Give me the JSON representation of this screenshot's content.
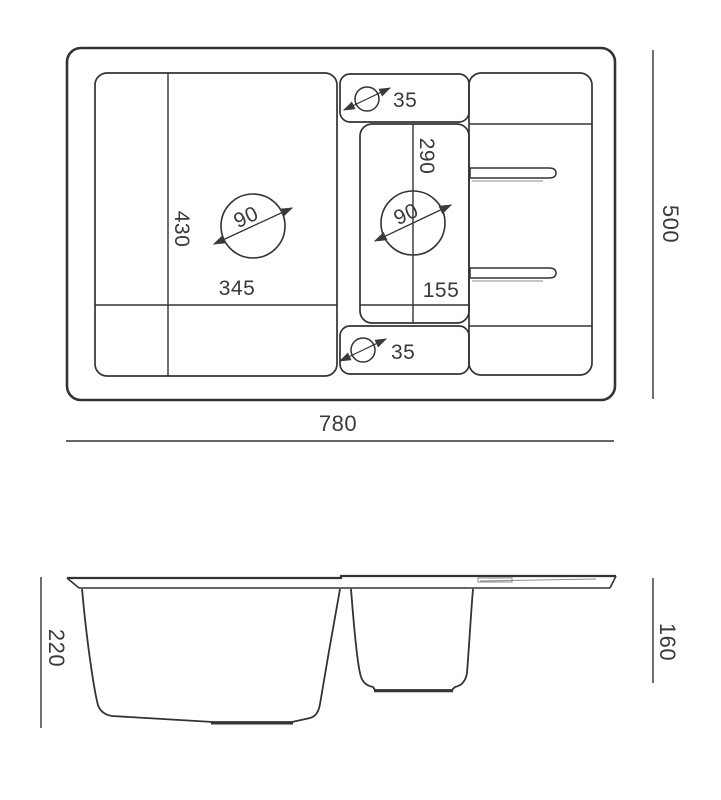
{
  "colors": {
    "line": "#333333",
    "line_soft": "#8a8a8a",
    "text": "#3a3a3a",
    "background": "#ffffff"
  },
  "top_view": {
    "overall_width_label": "780",
    "overall_depth_label": "500",
    "main_bowl": {
      "width_label": "345",
      "depth_label": "430",
      "drain_diameter_label": "90"
    },
    "small_bowl": {
      "width_label": "155",
      "depth_label": "290",
      "drain_diameter_label": "90"
    },
    "tap_hole_top_label": "35",
    "tap_hole_bottom_label": "35"
  },
  "side_view": {
    "main_bowl_depth_label": "220",
    "drainer_end_depth_label": "160"
  }
}
